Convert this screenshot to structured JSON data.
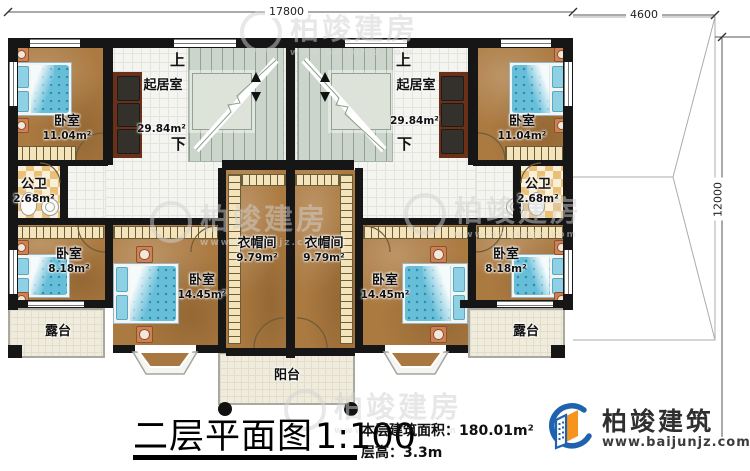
{
  "plan": {
    "dimensions": {
      "top_width": "17800",
      "roof_width": "4600",
      "right_height": "12000"
    },
    "stairs": {
      "up": "上",
      "down": "下"
    },
    "rooms": {
      "bedroom_top_left": {
        "name": "卧室",
        "area": "11.04m²"
      },
      "bedroom_top_right": {
        "name": "卧室",
        "area": "11.04m²"
      },
      "living_left": {
        "name": "起居室",
        "area": "29.84m²"
      },
      "living_right": {
        "name": "起居室",
        "area": "29.84m²"
      },
      "bath_left": {
        "name": "公卫",
        "area": "2.68m²"
      },
      "bath_right": {
        "name": "公卫",
        "area": "2.68m²"
      },
      "bedroom_bottom_left": {
        "name": "卧室",
        "area": "8.18m²"
      },
      "bedroom_bottom_right": {
        "name": "卧室",
        "area": "8.18m²"
      },
      "bedroom_mid_left": {
        "name": "卧室",
        "area": "14.45m²"
      },
      "bedroom_mid_right": {
        "name": "卧室",
        "area": "14.45m²"
      },
      "cloakroom_left": {
        "name": "衣帽间",
        "area": "9.79m²"
      },
      "cloakroom_right": {
        "name": "衣帽间",
        "area": "9.79m²"
      },
      "terrace_left": {
        "name": "露台"
      },
      "terrace_right": {
        "name": "露台"
      },
      "balcony": {
        "name": "阳台"
      }
    }
  },
  "title_block": {
    "title": "二层平面图",
    "scale": "1:100",
    "area_label": "本层建筑面积：",
    "area_value": "180.01m²",
    "floor_height_label": "层高：",
    "floor_height_value": "3.3m"
  },
  "brand": {
    "name": "柏竣建筑",
    "website": "www.baijunjz.com"
  },
  "watermark": {
    "text": "柏竣建房",
    "website": "www.baijunjz.com"
  },
  "colors": {
    "wall": "#161616",
    "wood": "#ab7a41",
    "accent_blue": "#1f63ae",
    "accent_orange": "#f7941d",
    "bed_blue": "#66bed9"
  }
}
